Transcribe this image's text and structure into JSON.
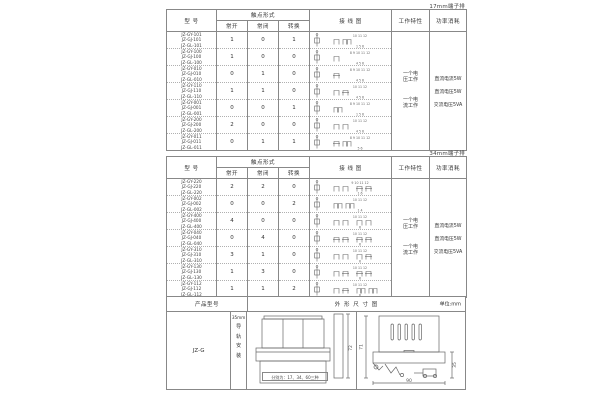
{
  "colors": {
    "line": "#888888",
    "diagram_line": "#666666",
    "text": "#333333"
  },
  "section1": {
    "corner_label": "17mm端子排",
    "header": {
      "model": "型 号",
      "contact_form": "触点形式",
      "no": "常开",
      "nc": "常闭",
      "co": "转换",
      "wiring": "接 线 图",
      "working": "工作特性",
      "power": "功率消耗"
    },
    "working_items": [
      "一个电压工作",
      "一个电流工作"
    ],
    "power_items": [
      "直流电流5W",
      "直流电压5W",
      "交流电压5VA"
    ],
    "rows": [
      {
        "models": [
          "JZ-GY-101",
          "JZ-GJ-101",
          "JZ-GL-101"
        ],
        "no": 1,
        "nc": 0,
        "co": 1,
        "top": "10 11 12",
        "bottom": "1 5 6"
      },
      {
        "models": [
          "JZ-GY-100",
          "JZ-GJ-100",
          "JZ-GL-100"
        ],
        "no": 1,
        "nc": 0,
        "co": 0,
        "top": "8 9 10 11 12",
        "bottom": "4 5 6"
      },
      {
        "models": [
          "JZ-GY-010",
          "JZ-GJ-010",
          "JZ-GL-010"
        ],
        "no": 0,
        "nc": 1,
        "co": 0,
        "top": "8 9 10 11 12",
        "bottom": "4 5 6"
      },
      {
        "models": [
          "JZ-GY-110",
          "JZ-GJ-110",
          "JZ-GL-110"
        ],
        "no": 1,
        "nc": 1,
        "co": 0,
        "top": "10 11 12",
        "bottom": "4 5 6"
      },
      {
        "models": [
          "JZ-GY-001",
          "JZ-GJ-001",
          "JZ-GL-001"
        ],
        "no": 0,
        "nc": 0,
        "co": 1,
        "top": "8 9 10 11 12",
        "bottom": "1 5 6"
      },
      {
        "models": [
          "JZ-GY-200",
          "JZ-GJ-200",
          "JZ-GL-200"
        ],
        "no": 2,
        "nc": 0,
        "co": 0,
        "top": "10 11 12",
        "bottom": "4 5 6"
      },
      {
        "models": [
          "JZ-GY-011",
          "JZ-GJ-011",
          "JZ-GL-011"
        ],
        "no": 0,
        "nc": 1,
        "co": 1,
        "top": "8 9 10 11 12",
        "bottom": "5 6"
      }
    ]
  },
  "section2": {
    "corner_label": "34mm端子排",
    "header": {
      "model": "型 号",
      "contact_form": "触点形式",
      "no": "常开",
      "nc": "常闭",
      "co": "转换",
      "wiring": "接 线 图",
      "working": "工作特性",
      "power": "功率消耗"
    },
    "working_items": [
      "一个电压工作",
      "一个电流工作"
    ],
    "power_items": [
      "直流电流5W",
      "直流电压5W",
      "交流电压5VA"
    ],
    "rows": [
      {
        "models": [
          "JZ-GY-220",
          "JZ-GJ-220",
          "JZ-GL-220"
        ],
        "no": 2,
        "nc": 2,
        "co": 0,
        "top": "9 10 11 12",
        "bottom": "1 6"
      },
      {
        "models": [
          "JZ-GY-002",
          "JZ-GJ-002",
          "JZ-GL-002"
        ],
        "no": 0,
        "nc": 0,
        "co": 2,
        "top": "10 11 12",
        "bottom": "1 4"
      },
      {
        "models": [
          "JZ-GY-400",
          "JZ-GJ-400",
          "JZ-GL-400"
        ],
        "no": 4,
        "nc": 0,
        "co": 0,
        "top": "10 11 12",
        "bottom": "6"
      },
      {
        "models": [
          "JZ-GY-040",
          "JZ-GJ-040",
          "JZ-GL-040"
        ],
        "no": 0,
        "nc": 4,
        "co": 0,
        "top": "10 11 12",
        "bottom": "6"
      },
      {
        "models": [
          "JZ-GY-310",
          "JZ-GJ-310",
          "JZ-GL-310"
        ],
        "no": 3,
        "nc": 1,
        "co": 0,
        "top": "10 11 12",
        "bottom": "6"
      },
      {
        "models": [
          "JZ-GY-130",
          "JZ-GJ-130",
          "JZ-GL-130"
        ],
        "no": 1,
        "nc": 3,
        "co": 0,
        "top": "10 11 12",
        "bottom": "6"
      },
      {
        "models": [
          "JZ-GY-112",
          "JZ-GJ-112",
          "JZ-GL-112"
        ],
        "no": 1,
        "nc": 1,
        "co": 2,
        "top": "10 11 12",
        "bottom": "6"
      }
    ]
  },
  "section3": {
    "header": {
      "product_model": "产品型号",
      "outline": "外 形 尺 寸 图",
      "unit": "单位:mm"
    },
    "product_model": "JZ-G",
    "rail_size": "35mm",
    "rail_mount": "导轨安装",
    "front_caption": "分别为：17、34、60三种",
    "dims": {
      "front_height": "72",
      "side_height": "71",
      "side_width": "90",
      "side_clamp": "35"
    }
  }
}
